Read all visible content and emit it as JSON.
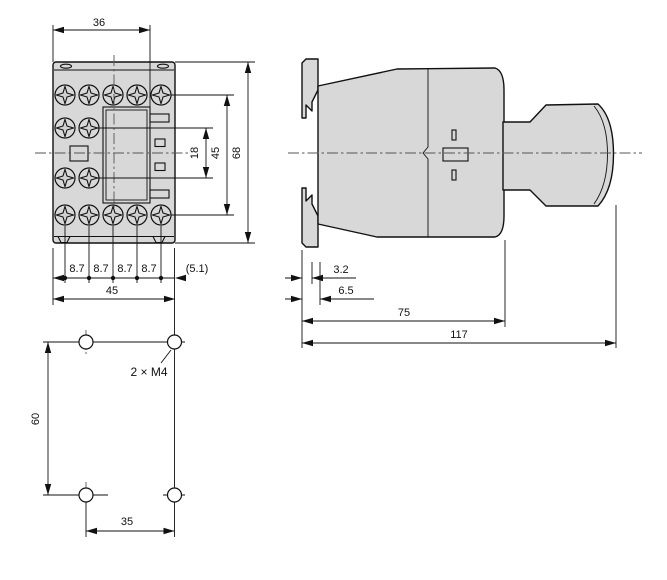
{
  "drawing": {
    "front_view": {
      "dim_top_width": "36",
      "dim_aux_contact_spacing": "18",
      "dim_contact_row_height": "45",
      "dim_total_height": "68",
      "pitch": [
        "8.7",
        "8.7",
        "8.7",
        "8.7"
      ],
      "dim_edge_offset": "(5.1)",
      "dim_total_width": "45"
    },
    "side_view": {
      "dim_rail_lip": "3.2",
      "dim_clip_depth": "6.5",
      "dim_body_depth": "75",
      "dim_total_depth": "117"
    },
    "mounting_pattern": {
      "dim_hole_vertical": "60",
      "dim_hole_horizontal": "35",
      "hole_spec": "2 × M4"
    }
  }
}
